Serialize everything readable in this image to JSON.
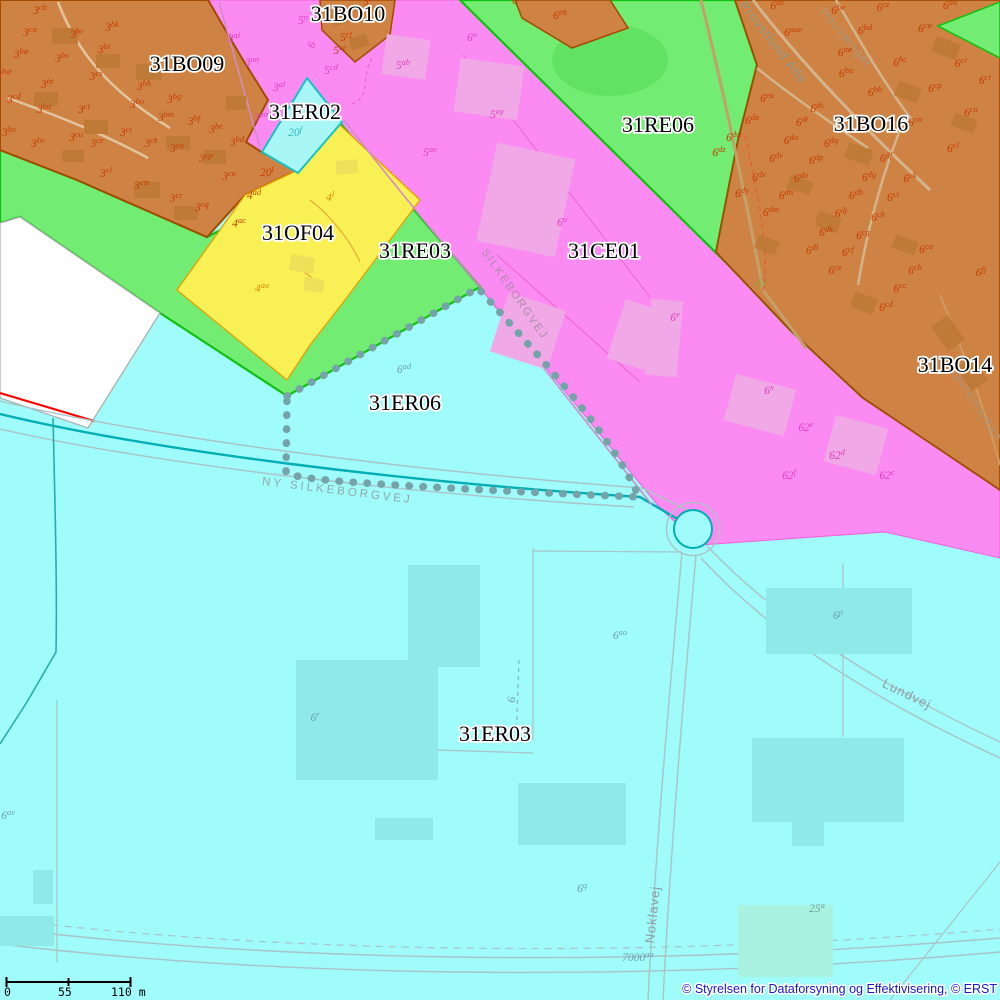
{
  "map": {
    "colors": {
      "background_cyan": "#A0FBFB",
      "magenta_zone": "#FB8BF3",
      "green_zone": "#72EC72",
      "orange_zone": "#CE8345",
      "yellow_zone": "#F8F055",
      "cyan_parcel_zone": "#A8F6F6",
      "white_zone": "#FFFFFF",
      "road_teal": "#00AEB4",
      "selection_dots": "#76A3A9",
      "parcel_text_orange": "#C83C00",
      "parcel_text_magenta": "#E03FBE",
      "parcel_text_yellow": "#DB8E00",
      "parcel_text_cyan": "#6FA0AA",
      "parcel_text_teal": "#2FB9B9",
      "parcel_text_olive": "#97A03F"
    },
    "zones": [
      [
        "31BO10",
        348,
        21
      ],
      [
        "31BO09",
        187,
        71
      ],
      [
        "31ER02",
        305,
        119
      ],
      [
        "31BO16",
        871,
        131
      ],
      [
        "31RE06",
        658,
        132
      ],
      [
        "31OF04",
        298,
        240
      ],
      [
        "31RE03",
        415,
        258
      ],
      [
        "31CE01",
        604,
        258
      ],
      [
        "31BO14",
        955,
        372
      ],
      [
        "31ER06",
        405,
        410
      ],
      [
        "31ER03",
        495,
        741
      ]
    ],
    "parcels": [
      [
        "3",
        "cb",
        40,
        14,
        "or",
        0
      ],
      [
        "3",
        "ca",
        30,
        36,
        "or",
        0
      ],
      [
        "3",
        "br",
        77,
        38,
        "or",
        0
      ],
      [
        "3",
        "bk",
        112,
        31,
        "or",
        0
      ],
      [
        "3",
        "bi",
        104,
        53,
        "or",
        0
      ],
      [
        "3",
        "bø",
        21,
        58,
        "or",
        0
      ],
      [
        "3",
        "bs",
        62,
        62,
        "or",
        0
      ],
      [
        "3",
        "bæ",
        4,
        78,
        "or",
        0
      ],
      [
        "3",
        "bt",
        47,
        88,
        "or",
        0
      ],
      [
        "3",
        "cs",
        96,
        80,
        "or",
        0
      ],
      [
        "3",
        "cd",
        14,
        103,
        "or",
        0
      ],
      [
        "3",
        "bu",
        44,
        113,
        "or",
        0
      ],
      [
        "3",
        "ct",
        84,
        113,
        "or",
        0
      ],
      [
        "3",
        "bh",
        144,
        90,
        "or",
        0
      ],
      [
        "3",
        "bo",
        137,
        108,
        "or",
        0
      ],
      [
        "3",
        "bg",
        174,
        103,
        "or",
        0
      ],
      [
        "3",
        "bm",
        166,
        121,
        "or",
        0
      ],
      [
        "3",
        "bf",
        194,
        125,
        "or",
        0
      ],
      [
        "3",
        "be",
        216,
        133,
        "or",
        0
      ],
      [
        "3",
        "bx",
        9,
        136,
        "or",
        0
      ],
      [
        "3",
        "bv",
        38,
        147,
        "or",
        0
      ],
      [
        "3",
        "cu",
        76,
        141,
        "or",
        0
      ],
      [
        "3",
        "ce",
        97,
        147,
        "or",
        0
      ],
      [
        "3",
        "ci",
        126,
        136,
        "or",
        0
      ],
      [
        "3",
        "ck",
        151,
        147,
        "or",
        0
      ],
      [
        "3",
        "co",
        177,
        152,
        "or",
        0
      ],
      [
        "3",
        "cp",
        206,
        162,
        "or",
        0
      ],
      [
        "3",
        "bd",
        237,
        146,
        "or",
        0
      ],
      [
        "3",
        "cn",
        229,
        180,
        "or",
        0
      ],
      [
        "3",
        "cl",
        106,
        177,
        "or",
        0
      ],
      [
        "3",
        "cm",
        142,
        189,
        "or",
        0
      ],
      [
        "3",
        "cr",
        176,
        202,
        "or",
        0
      ],
      [
        "3",
        "cq",
        202,
        211,
        "or",
        0
      ],
      [
        "4",
        "ad",
        254,
        199,
        "or",
        0
      ],
      [
        "4",
        "ac",
        239,
        227,
        "or",
        0
      ],
      [
        "20",
        "l",
        267,
        176,
        "or",
        0
      ],
      [
        "3",
        "ai",
        234,
        42,
        "mg",
        0
      ],
      [
        "3",
        "an",
        252,
        66,
        "mg",
        0
      ],
      [
        "3",
        "al",
        279,
        91,
        "mg",
        0
      ],
      [
        "3",
        "am",
        262,
        121,
        "mg",
        0
      ],
      [
        "5",
        "n",
        303,
        24,
        "mg",
        0
      ],
      [
        "5",
        "cd",
        331,
        74,
        "mg",
        0
      ],
      [
        "5",
        "ab",
        403,
        69,
        "mg",
        0
      ],
      [
        "6",
        "o",
        472,
        41,
        "mg",
        0
      ],
      [
        "5",
        "ay",
        497,
        118,
        "mg",
        0
      ],
      [
        "5",
        "ae",
        430,
        156,
        "mg",
        0
      ],
      [
        "6",
        "u",
        562,
        226,
        "mg",
        0
      ],
      [
        "5",
        "bv",
        370,
        5,
        "or",
        0
      ],
      [
        "5",
        "cf",
        346,
        41,
        "or",
        0
      ],
      [
        "5",
        "ce",
        340,
        54,
        "or",
        0
      ],
      [
        "20",
        "f",
        295,
        136,
        "tl",
        0
      ],
      [
        "4",
        "l",
        330,
        201,
        "yl",
        0
      ],
      [
        "4",
        "aa",
        262,
        292,
        "yl",
        0
      ],
      [
        "6",
        "eb",
        519,
        4,
        "or",
        0
      ],
      [
        "6",
        "eh",
        560,
        19,
        "or",
        0
      ],
      [
        "6",
        "az",
        777,
        9,
        "or",
        0
      ],
      [
        "6",
        "aae",
        793,
        36,
        "or",
        0
      ],
      [
        "6",
        "aø",
        845,
        56,
        "or",
        0
      ],
      [
        "6",
        "ba",
        846,
        77,
        "or",
        0
      ],
      [
        "6",
        "bb",
        875,
        96,
        "or",
        0
      ],
      [
        "6",
        "be",
        838,
        14,
        "or",
        0
      ],
      [
        "6",
        "bd",
        865,
        34,
        "or",
        0
      ],
      [
        "6",
        "bc",
        900,
        66,
        "or",
        0
      ],
      [
        "6",
        "cz",
        883,
        11,
        "or",
        0
      ],
      [
        "6",
        "cø",
        925,
        32,
        "or",
        0
      ],
      [
        "6",
        "da",
        950,
        9,
        "or",
        0
      ],
      [
        "6",
        "cr",
        961,
        67,
        "or",
        0
      ],
      [
        "6",
        "cp",
        935,
        92,
        "or",
        0
      ],
      [
        "6",
        "ct",
        985,
        84,
        "or",
        0
      ],
      [
        "6",
        "cu",
        971,
        116,
        "or",
        0
      ],
      [
        "6",
        "cn",
        915,
        126,
        "or",
        0
      ],
      [
        "6",
        "cl",
        953,
        152,
        "or",
        0
      ],
      [
        "6",
        "ck",
        910,
        182,
        "or",
        0
      ],
      [
        "6",
        "ci",
        893,
        201,
        "or",
        0
      ],
      [
        "6",
        "ch",
        878,
        221,
        "or",
        0
      ],
      [
        "6",
        "cg",
        863,
        239,
        "or",
        0
      ],
      [
        "6",
        "cf",
        848,
        256,
        "or",
        0
      ],
      [
        "6",
        "ce",
        835,
        274,
        "or",
        0
      ],
      [
        "6",
        "cb",
        915,
        274,
        "or",
        0
      ],
      [
        "6",
        "cc",
        900,
        292,
        "or",
        0
      ],
      [
        "6",
        "cd",
        886,
        311,
        "or",
        0
      ],
      [
        "6",
        "ca",
        926,
        253,
        "or",
        0
      ],
      [
        "6",
        "fj",
        981,
        276,
        "or",
        0
      ],
      [
        "6",
        "dø",
        752,
        124,
        "or",
        0
      ],
      [
        "6",
        "dæ",
        734,
        141,
        "or",
        0
      ],
      [
        "6",
        "dz",
        719,
        156,
        "or",
        0
      ],
      [
        "6",
        "du",
        791,
        144,
        "or",
        0
      ],
      [
        "6",
        "dq",
        831,
        147,
        "or",
        0
      ],
      [
        "6",
        "dv",
        776,
        162,
        "or",
        0
      ],
      [
        "6",
        "dp",
        816,
        164,
        "or",
        0
      ],
      [
        "6",
        "df",
        886,
        162,
        "or",
        0
      ],
      [
        "6",
        "dx",
        759,
        181,
        "or",
        0
      ],
      [
        "6",
        "do",
        801,
        182,
        "or",
        0
      ],
      [
        "6",
        "dg",
        869,
        181,
        "or",
        0
      ],
      [
        "6",
        "dy",
        742,
        197,
        "or",
        0
      ],
      [
        "6",
        "dn",
        786,
        199,
        "or",
        0
      ],
      [
        "6",
        "dh",
        856,
        199,
        "or",
        0
      ],
      [
        "6",
        "dm",
        771,
        216,
        "or",
        0
      ],
      [
        "6",
        "dj",
        841,
        217,
        "or",
        0
      ],
      [
        "6",
        "dk",
        826,
        236,
        "or",
        0
      ],
      [
        "6",
        "dl",
        812,
        254,
        "or",
        0
      ],
      [
        "6",
        "ds",
        817,
        112,
        "or",
        0
      ],
      [
        "6",
        "dt",
        802,
        126,
        "or",
        0
      ],
      [
        "6",
        "ea",
        767,
        102,
        "or",
        0
      ],
      [
        "6",
        "v",
        675,
        321,
        "mg",
        0
      ],
      [
        "6",
        "x",
        769,
        394,
        "mg",
        0
      ],
      [
        "62",
        "e",
        806,
        431,
        "mg",
        0
      ],
      [
        "62",
        "d",
        837,
        459,
        "mg",
        0
      ],
      [
        "62",
        "f",
        789,
        479,
        "mg",
        0
      ],
      [
        "62",
        "c",
        887,
        479,
        "mg",
        0
      ],
      [
        "6",
        "ad",
        404,
        373,
        "cy",
        0
      ],
      [
        "6",
        "ao",
        620,
        639,
        "cy",
        0
      ],
      [
        "6",
        "r",
        315,
        721,
        "cy",
        0
      ],
      [
        "6",
        "p",
        838,
        619,
        "cy",
        0
      ],
      [
        "6",
        "q",
        582,
        892,
        "cy",
        0
      ],
      [
        "25",
        "a",
        817,
        912,
        "cy",
        0
      ],
      [
        "6",
        "av",
        8,
        819,
        "cy",
        0
      ],
      [
        "7000",
        "aa",
        638,
        961,
        "cy",
        0
      ],
      [
        "59",
        "",
        762,
        287,
        "ol",
        -38
      ],
      [
        "6",
        "",
        315,
        46,
        "mg",
        -72
      ],
      [
        "6",
        "",
        515,
        700,
        "cy",
        -85
      ]
    ],
    "streets": [
      [
        "Provstlund Alle",
        770,
        45,
        52,
        13,
        1,
        "#8C9B8C"
      ],
      [
        "Hovvænget",
        843,
        40,
        50,
        12.5,
        1,
        "#A89878"
      ],
      [
        "Havremarken",
        972,
        405,
        57,
        13,
        1,
        "#B09272"
      ],
      [
        "Lundvej",
        905,
        698,
        26,
        13,
        1,
        "#8C9FA6"
      ],
      [
        "Noklavej",
        657,
        915,
        -84,
        13,
        1,
        "#8C9FA6"
      ],
      [
        "NY SILKEBORGVEJ",
        337,
        494,
        7,
        11.5,
        3,
        "#93A8AB"
      ],
      [
        "SILKEBORGVEJ",
        512,
        296,
        55,
        11,
        2,
        "#AD8BA8"
      ]
    ]
  },
  "scalebar": {
    "t0": "0",
    "t1": "55",
    "t2": "110 m"
  },
  "attribution": "© Styrelsen for Dataforsyning og Effektivisering, © ERST"
}
